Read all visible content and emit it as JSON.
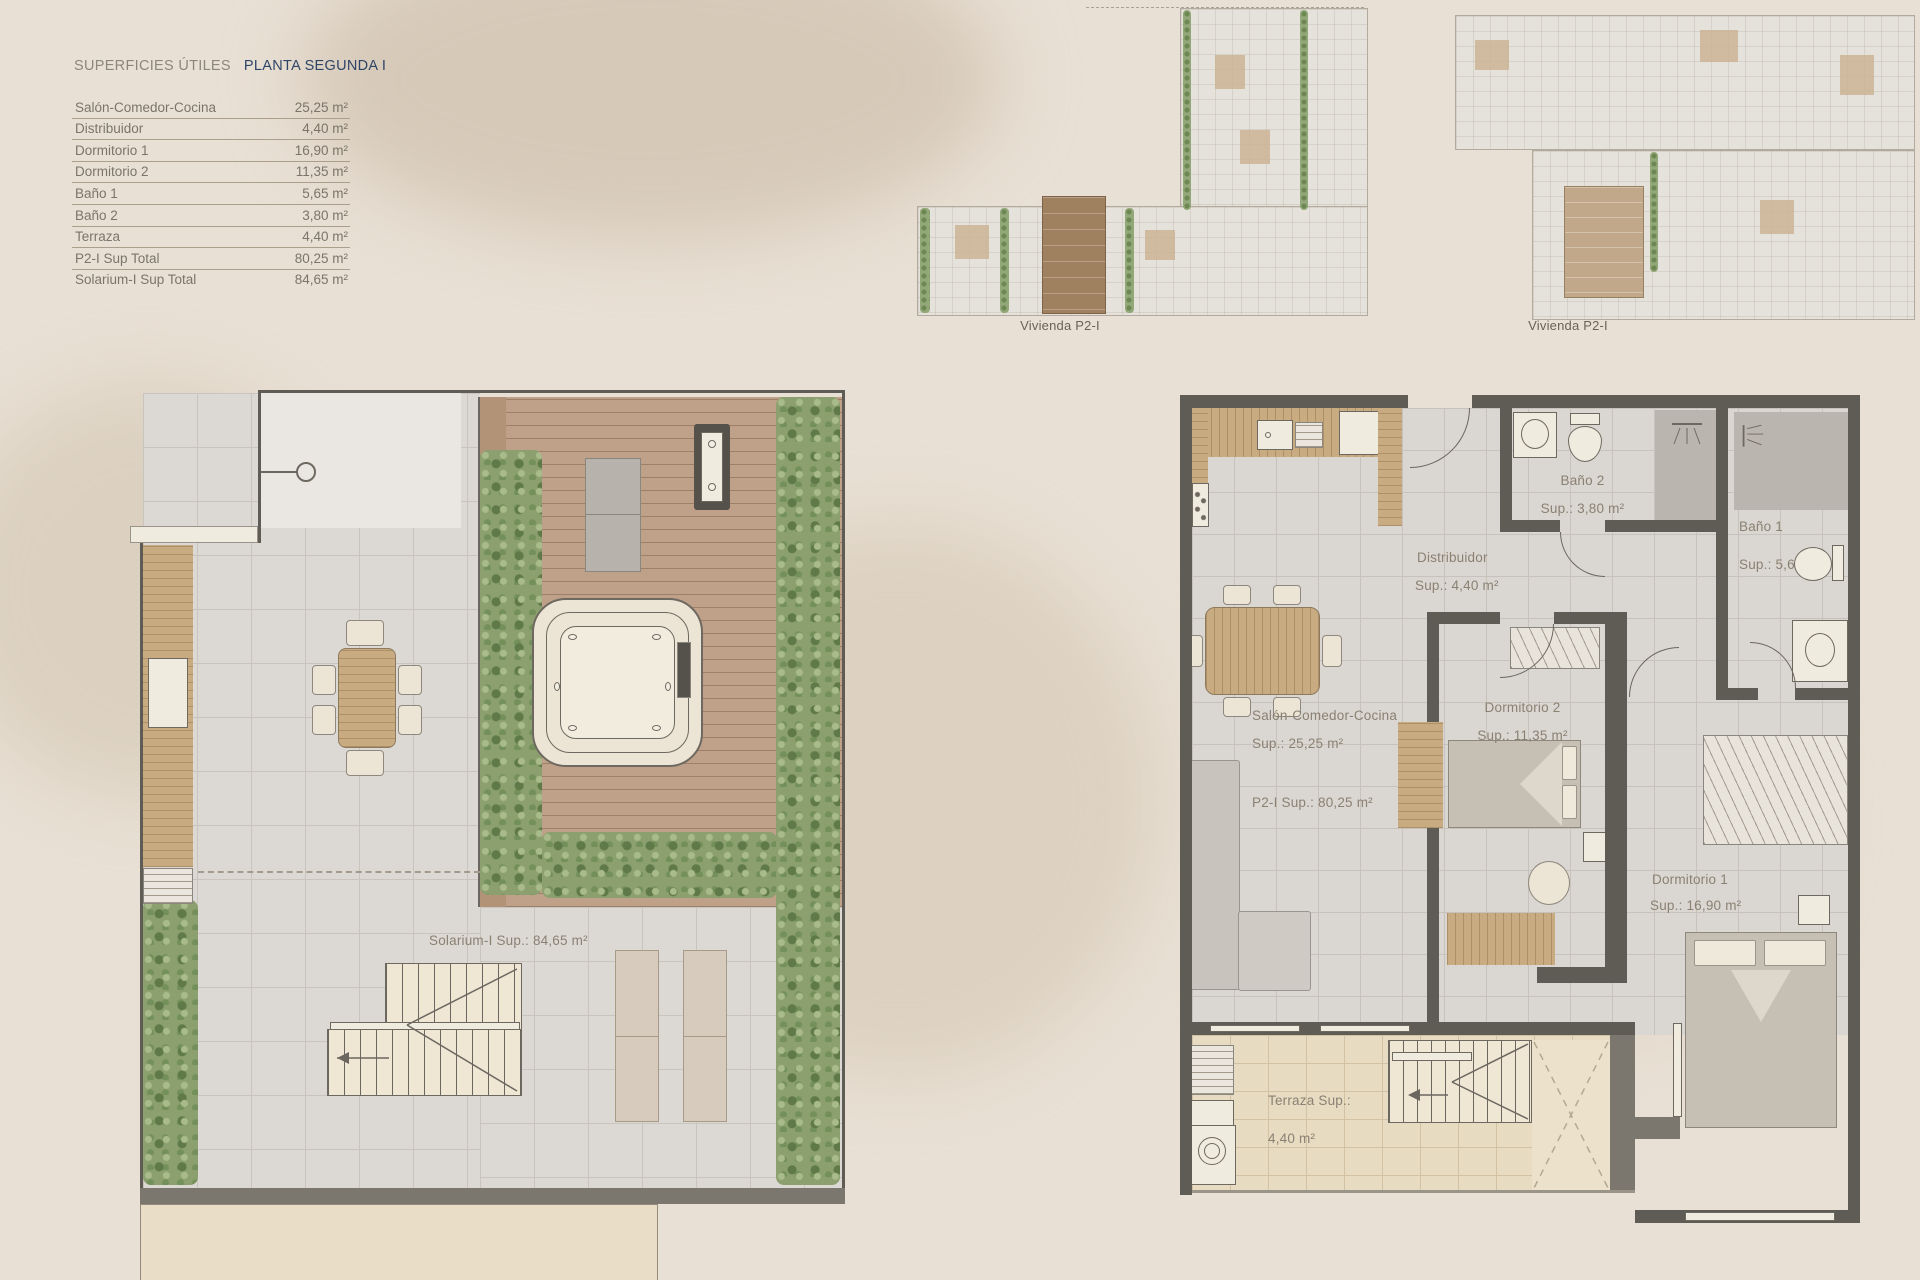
{
  "areas_table": {
    "title_left": "SUPERFICIES ÚTILES",
    "title_right": "PLANTA SEGUNDA I",
    "rows": [
      {
        "label": "Salón-Comedor-Cocina",
        "value": "25,25 m²"
      },
      {
        "label": "Distribuidor",
        "value": "4,40 m²"
      },
      {
        "label": "Dormitorio 1",
        "value": "16,90 m²"
      },
      {
        "label": "Dormitorio 2",
        "value": "11,35 m²"
      },
      {
        "label": "Baño 1",
        "value": "5,65 m²"
      },
      {
        "label": "Baño 2",
        "value": "3,80 m²"
      },
      {
        "label": "Terraza",
        "value": "4,40 m²"
      },
      {
        "label": "P2-I Sup Total",
        "value": "80,25 m²"
      },
      {
        "label": "Solarium-I Sup Total",
        "value": "84,65 m²"
      }
    ]
  },
  "key_plans": {
    "captions": [
      "Vivienda P2-I",
      "Vivienda P2-I"
    ]
  },
  "solarium": {
    "area_label": "Solarium-I Sup.: 84,65 m²"
  },
  "apt": {
    "salon": {
      "name": "Salón-Comedor-Cocina",
      "sup": "Sup.: 25,25 m²"
    },
    "total": "P2-I Sup.: 80,25 m²",
    "distribuidor": {
      "name": "Distribuidor",
      "sup": "Sup.: 4,40 m²"
    },
    "bano2": {
      "name": "Baño 2",
      "sup": "Sup.: 3,80 m²"
    },
    "bano1": {
      "name": "Baño 1",
      "sup": "Sup.: 5,65 m²"
    },
    "dorm2": {
      "name": "Dormitorio 2",
      "sup": "Sup.: 11,35 m²"
    },
    "dorm1": {
      "name": "Dormitorio 1",
      "sup": "Sup.: 16,90 m²"
    },
    "terraza": {
      "name": "Terraza Sup.:",
      "sup": "4,40 m²"
    }
  },
  "colors": {
    "page_bg": "#e9e0d5",
    "wall": "#5f5b55",
    "wall_gray": "#7b766e",
    "tile": "#dad6d1",
    "terrace_tile": "#e7dbc2",
    "deck_wood": "#bfa189",
    "furniture_wood": "#c9ab82",
    "hedge_green": "#8ba06e",
    "label_text": "#8a8173",
    "title_navy": "#2e4467",
    "title_gray": "#8d867a"
  }
}
